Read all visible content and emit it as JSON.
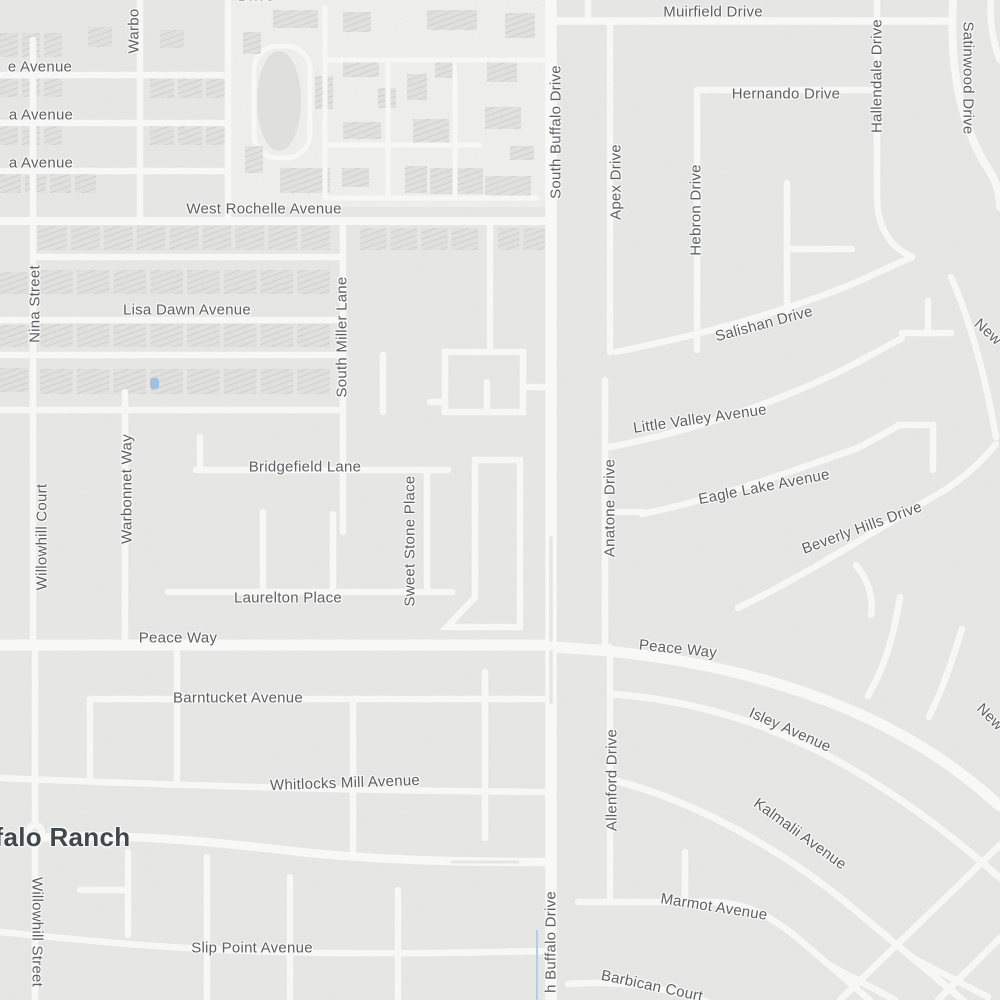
{
  "map": {
    "kind": "street-map",
    "colors": {
      "background": "#e9e9e7",
      "road": "#fbfbfa",
      "building_fill": "#e3e3e1",
      "building_hatch_line": "#cdcdcb",
      "street_label": "#5d5f62",
      "neighborhood_label": "#40484d",
      "water": "#b5d0e6"
    },
    "neighborhood_label": {
      "text": "ffalo Ranch",
      "x": 58,
      "y": 837
    },
    "street_labels": [
      {
        "text": "e Avenue",
        "x": 40,
        "y": 67,
        "r": 0
      },
      {
        "text": "a Avenue",
        "x": 41,
        "y": 115,
        "r": 0
      },
      {
        "text": "a Avenue",
        "x": 41,
        "y": 163,
        "r": 0
      },
      {
        "text": "Warbo",
        "x": 134,
        "y": 31,
        "r": -90
      },
      {
        "text": "Drive",
        "x": 256,
        "y": -4,
        "r": 0
      },
      {
        "text": "West Rochelle Avenue",
        "x": 264,
        "y": 209,
        "r": 0
      },
      {
        "text": "Nina Street",
        "x": 35,
        "y": 304,
        "r": -90
      },
      {
        "text": "Lisa Dawn Avenue",
        "x": 187,
        "y": 310,
        "r": 0
      },
      {
        "text": "South Miller Lane",
        "x": 342,
        "y": 337,
        "r": -90
      },
      {
        "text": "Muirfield Drive",
        "x": 713,
        "y": 12,
        "r": 0
      },
      {
        "text": "Hernando Drive",
        "x": 786,
        "y": 94,
        "r": 0
      },
      {
        "text": "South Buffalo Drive",
        "x": 556,
        "y": 132,
        "r": -90
      },
      {
        "text": "Apex Drive",
        "x": 616,
        "y": 182,
        "r": -90
      },
      {
        "text": "Hebron Drive",
        "x": 696,
        "y": 210,
        "r": -90
      },
      {
        "text": "Hallendale Drive",
        "x": 877,
        "y": 76,
        "r": -90
      },
      {
        "text": "Satinwood Drive",
        "x": 968,
        "y": 78,
        "r": 90
      },
      {
        "text": "Salishan Drive",
        "x": 764,
        "y": 324,
        "r": -15
      },
      {
        "text": "New",
        "x": 988,
        "y": 332,
        "r": 42
      },
      {
        "text": "Little Valley Avenue",
        "x": 700,
        "y": 419,
        "r": -8
      },
      {
        "text": "Eagle Lake Avenue",
        "x": 764,
        "y": 487,
        "r": -11
      },
      {
        "text": "Beverly Hills Drive",
        "x": 862,
        "y": 528,
        "r": -20
      },
      {
        "text": "Anatone Drive",
        "x": 610,
        "y": 508,
        "r": -90
      },
      {
        "text": "Bridgefield Lane",
        "x": 305,
        "y": 467,
        "r": 0
      },
      {
        "text": "Sweet Stone Place",
        "x": 410,
        "y": 541,
        "r": -90
      },
      {
        "text": "Warbonnet Way",
        "x": 127,
        "y": 489,
        "r": -90
      },
      {
        "text": "Willowhill Court",
        "x": 42,
        "y": 537,
        "r": -90
      },
      {
        "text": "Laurelton Place",
        "x": 288,
        "y": 598,
        "r": 0
      },
      {
        "text": "Peace Way",
        "x": 178,
        "y": 638,
        "r": 0
      },
      {
        "text": "Peace Way",
        "x": 678,
        "y": 649,
        "r": 6
      },
      {
        "text": "Barntucket Avenue",
        "x": 238,
        "y": 698,
        "r": 0
      },
      {
        "text": "Isley Avenue",
        "x": 790,
        "y": 730,
        "r": 24
      },
      {
        "text": "Whitlocks Mill Avenue",
        "x": 345,
        "y": 783,
        "r": -2
      },
      {
        "text": "Allenford Drive",
        "x": 612,
        "y": 780,
        "r": -90
      },
      {
        "text": "Kalmalii Avenue",
        "x": 800,
        "y": 834,
        "r": 36
      },
      {
        "text": "New",
        "x": 990,
        "y": 717,
        "r": 45
      },
      {
        "text": "Marmot Avenue",
        "x": 714,
        "y": 907,
        "r": 9
      },
      {
        "text": "Willowhill Street",
        "x": 37,
        "y": 932,
        "r": 90
      },
      {
        "text": "Slip Point Avenue",
        "x": 252,
        "y": 948,
        "r": 0
      },
      {
        "text": "Barbican Court",
        "x": 652,
        "y": 986,
        "r": 12
      },
      {
        "text": "h Buffalo Drive",
        "x": 551,
        "y": 942,
        "r": -90
      }
    ]
  }
}
